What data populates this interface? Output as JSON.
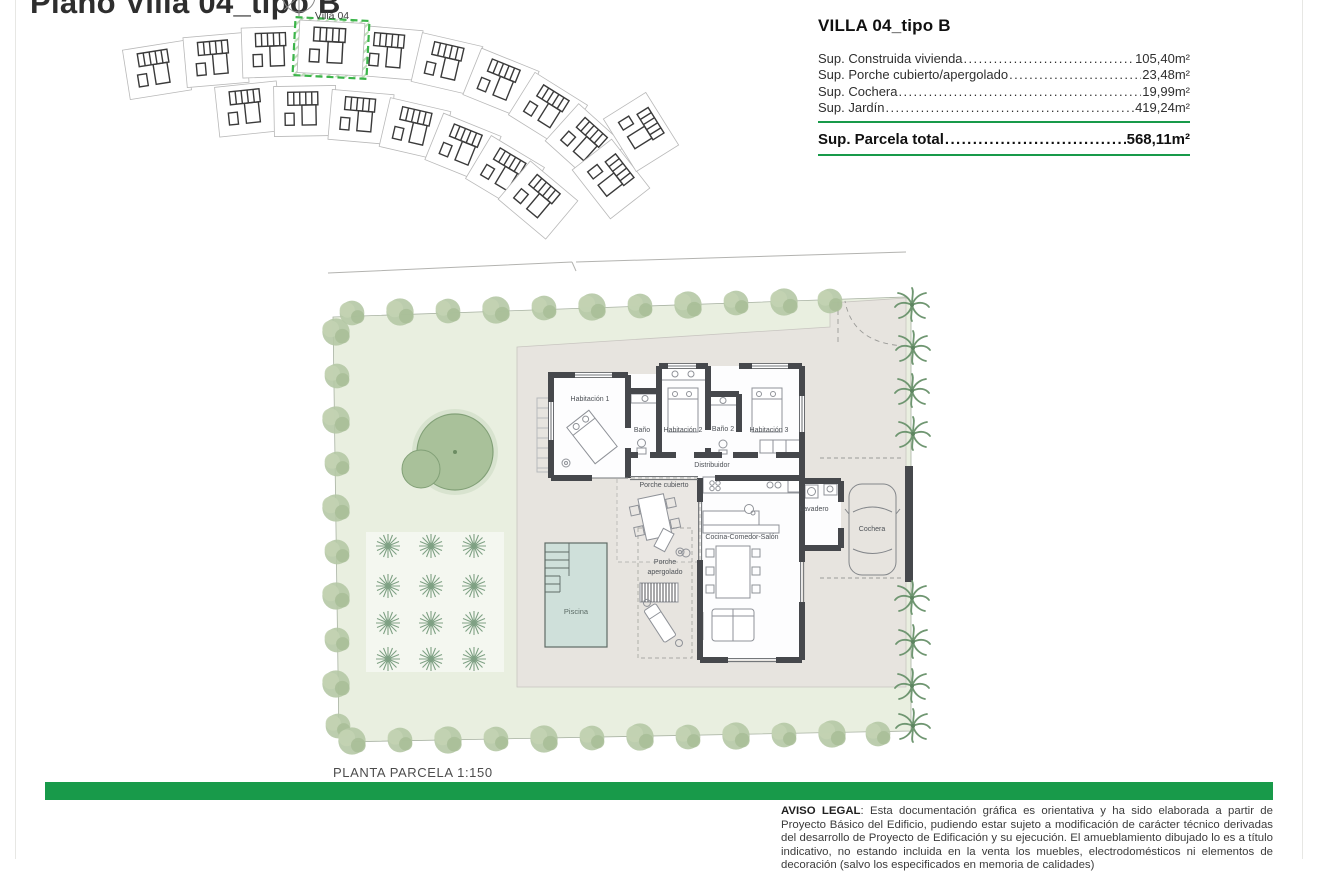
{
  "page": {
    "title": "Plano Villa 04_tipo B",
    "scale_label": "PLANTA PARCELA 1:150"
  },
  "site_plan": {
    "villa_label": "Villa 04"
  },
  "summary": {
    "title": "VILLA 04_tipo B",
    "rows": [
      {
        "label": "Sup. Construida vivienda",
        "value": "105,40m²"
      },
      {
        "label": "Sup. Porche cubierto/apergolado",
        "value": "23,48m²"
      },
      {
        "label": "Sup. Cochera",
        "value": "19,99m²"
      },
      {
        "label": "Sup. Jardín",
        "value": "419,24m²"
      }
    ],
    "total": {
      "label": "Sup. Parcela total",
      "value": "568,11m²"
    }
  },
  "floor_plan": {
    "hab1": "Habitación 1",
    "bano1": "Baño",
    "hab2": "Habitación 2",
    "bano2": "Baño 2",
    "hab3": "Habitación 3",
    "distribuidor": "Distribuidor",
    "porche_cubierto": "Porche cubierto",
    "cocina": "Cocina-Comedor-Salón",
    "lavadero": "Lavadero",
    "cochera": "Cochera",
    "porche_apergolado_1": "Porche",
    "porche_apergolado_2": "apergolado",
    "piscina": "Piscina"
  },
  "legal": {
    "title": "AVISO LEGAL",
    "text": ": Esta documentación gráfica es orientativa y ha sido elaborada a partir de Proyecto Básico del Edificio, pudiendo estar sujeto a modificación de carácter técnico derivadas del desarrollo de Proyecto de Edificación y su ejecución. El amueblamiento dibujado lo es a título indicativo, no estando incluida en la venta los muebles, electrodomésticos ni elementos de decoración (salvo los especificados en memoria de calidades)"
  },
  "colors": {
    "accent_green": "#189a4a",
    "highlight_green": "#3cb54a",
    "garden_green": "#e9efe0",
    "terrace_gray": "#e7e4df",
    "pool_blue": "#cfe0da",
    "wall_dark": "#46484c"
  }
}
